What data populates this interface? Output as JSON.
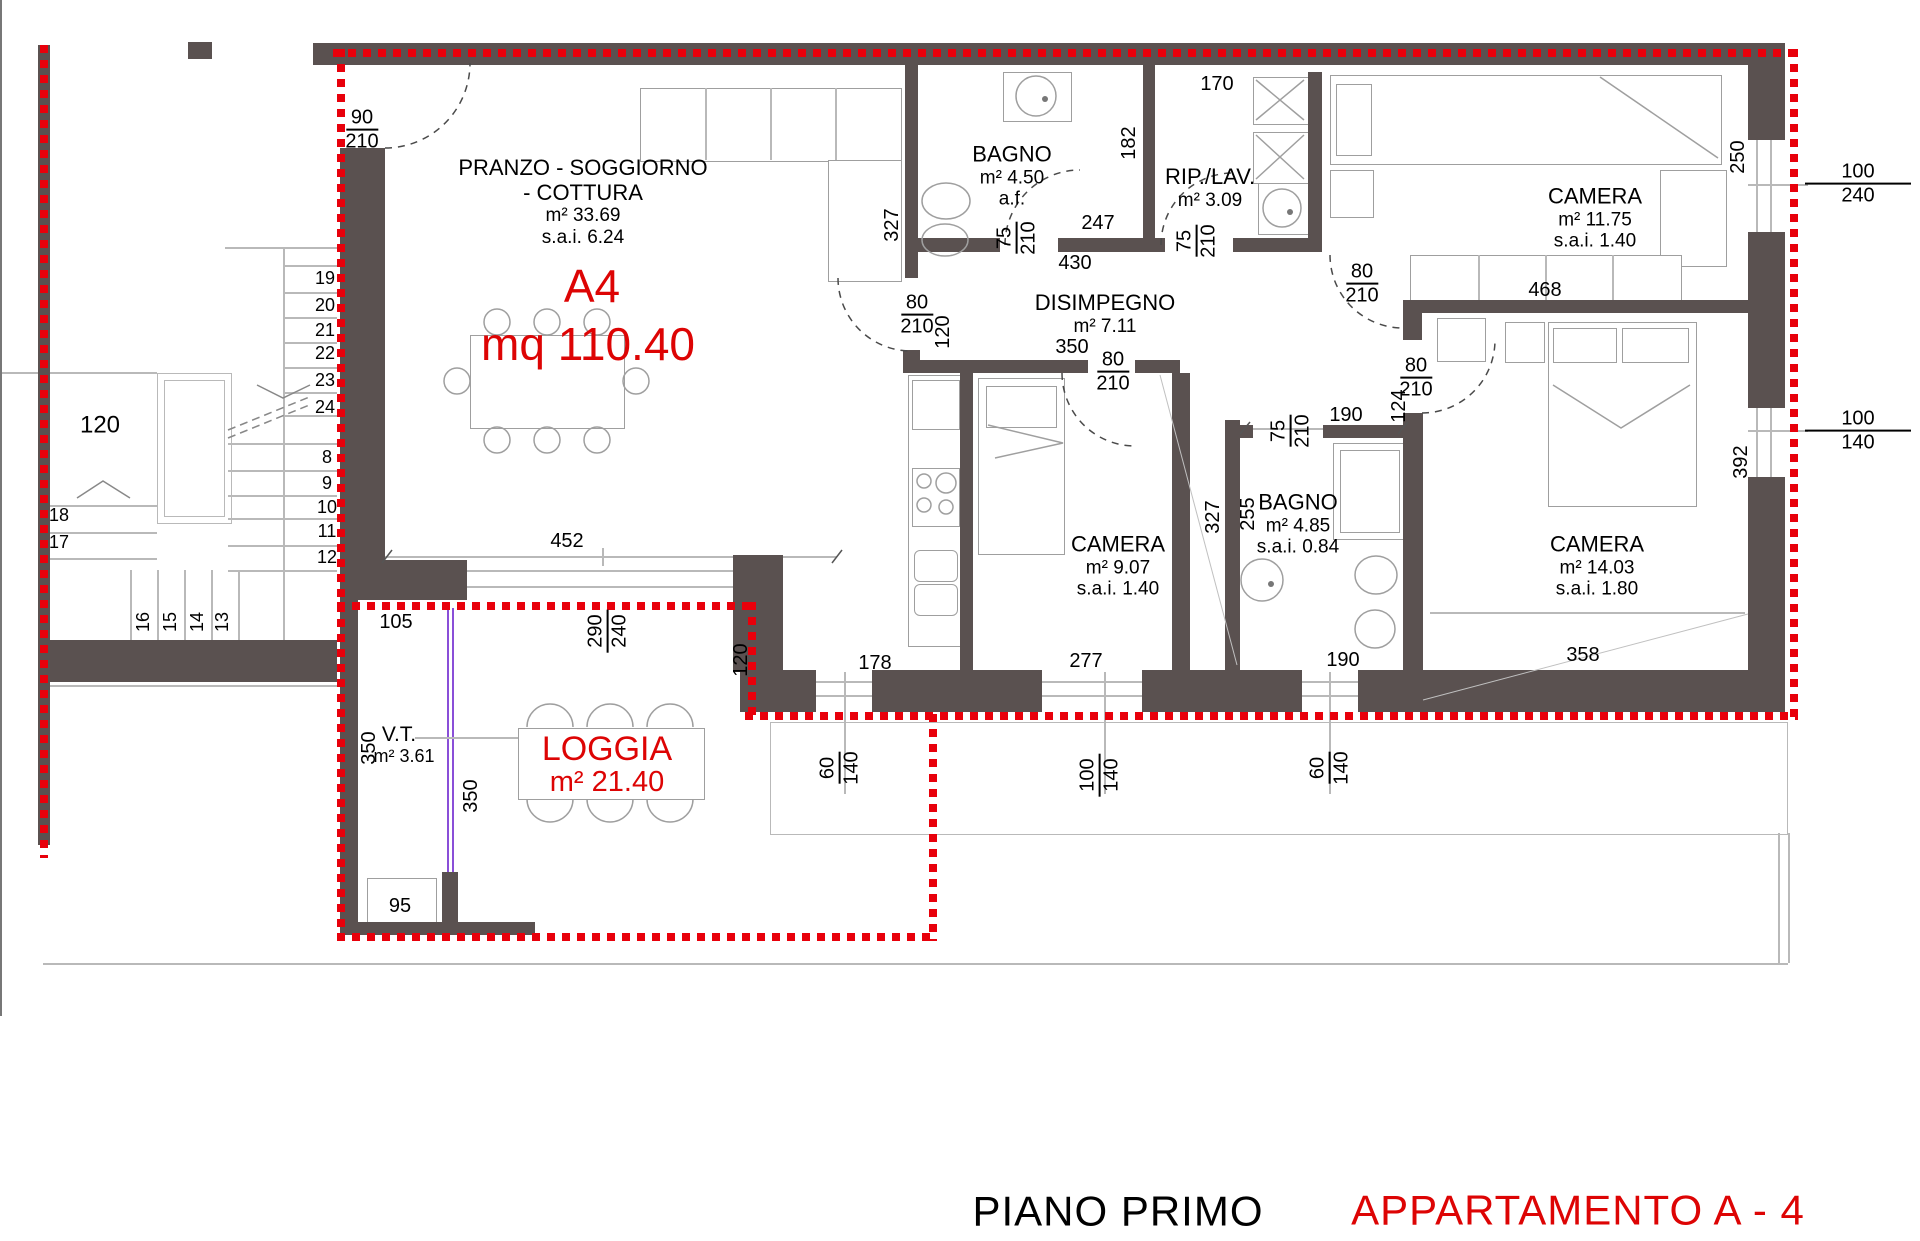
{
  "colors": {
    "wall": "#5a5150",
    "boundary_red": "#e8000b",
    "text_red": "#dd0404"
  },
  "title": {
    "floor": "PIANO PRIMO",
    "apartment": "APPARTAMENTO A - 4"
  },
  "unit": {
    "code": "A4",
    "total_area": "mq 110.40"
  },
  "rooms": {
    "living": {
      "line1": "PRANZO - SOGGIORNO",
      "line2": "- COTTURA",
      "area": "m² 33.69",
      "sai": "s.a.i. 6.24"
    },
    "bagno1": {
      "name": "BAGNO",
      "area": "m² 4.50",
      "note": "a.f."
    },
    "rip_lav": {
      "name": "RIP./LAV.",
      "area": "m² 3.09"
    },
    "disimpegno": {
      "name": "DISIMPEGNO",
      "area": "m² 7.11"
    },
    "camera_nord": {
      "name": "CAMERA",
      "area": "m² 11.75",
      "sai": "s.a.i. 1.40"
    },
    "camera_centro": {
      "name": "CAMERA",
      "area": "m² 9.07",
      "sai": "s.a.i. 1.40"
    },
    "bagno2": {
      "name": "BAGNO",
      "area": "m² 4.85",
      "sai": "s.a.i. 0.84"
    },
    "camera_sud": {
      "name": "CAMERA",
      "area": "m² 14.03",
      "sai": "s.a.i. 1.80"
    },
    "loggia": {
      "name": "LOGGIA",
      "area": "m² 21.40"
    },
    "vt": {
      "name": "V.T.",
      "area": "m² 3.61"
    }
  },
  "doors": {
    "entry": {
      "w": "90",
      "h": "210"
    },
    "living_disimpegno": {
      "w": "80",
      "h": "210",
      "wall": "120"
    },
    "bagno1": {
      "w": "75",
      "h": "210"
    },
    "rip_lav": {
      "w": "75",
      "h": "210"
    },
    "camera_nord": {
      "w": "80",
      "h": "210"
    },
    "camera_centro": {
      "w": "80",
      "h": "210"
    },
    "bagno2": {
      "w": "75",
      "h": "210"
    },
    "camera_sud": {
      "w": "80",
      "h": "210",
      "wall": "124"
    }
  },
  "windows": {
    "camera_nord": {
      "w": "100",
      "h": "240",
      "sill": "250"
    },
    "camera_sud": {
      "w": "100",
      "h": "140",
      "sill": "392"
    },
    "cucina": {
      "w": "60",
      "h": "140"
    },
    "camera_centro": {
      "w": "100",
      "h": "140"
    },
    "bagno2": {
      "w": "60",
      "h": "140"
    },
    "living_loggia": {
      "w": "290",
      "h": "240"
    }
  },
  "dims": {
    "living_width": "452",
    "bagno1_width": "247",
    "bagno1_height": "327",
    "bagno1_wall": "182",
    "disimpegno_top": "430",
    "disimpegno_width": "350",
    "rip_width": "170",
    "camera_nord_width": "468",
    "bagno2_top": "190",
    "bagno2_width": "255",
    "camera_centro_height": "327",
    "camera_sud_width": "358",
    "seg_cucina": "178",
    "seg_camera": "277",
    "seg_bagno2": "190",
    "loggia_offset": "120",
    "vt_niche": "105",
    "vt_d1": "350",
    "vt_d2": "350",
    "vt_box": "95",
    "stair_width": "120"
  },
  "stairs": {
    "upper": [
      "19",
      "20",
      "21",
      "22",
      "23",
      "24"
    ],
    "lower": [
      "8",
      "9",
      "10",
      "11",
      "12"
    ],
    "left": [
      "18",
      "17"
    ],
    "bottom": [
      "16",
      "15",
      "14",
      "13"
    ]
  }
}
